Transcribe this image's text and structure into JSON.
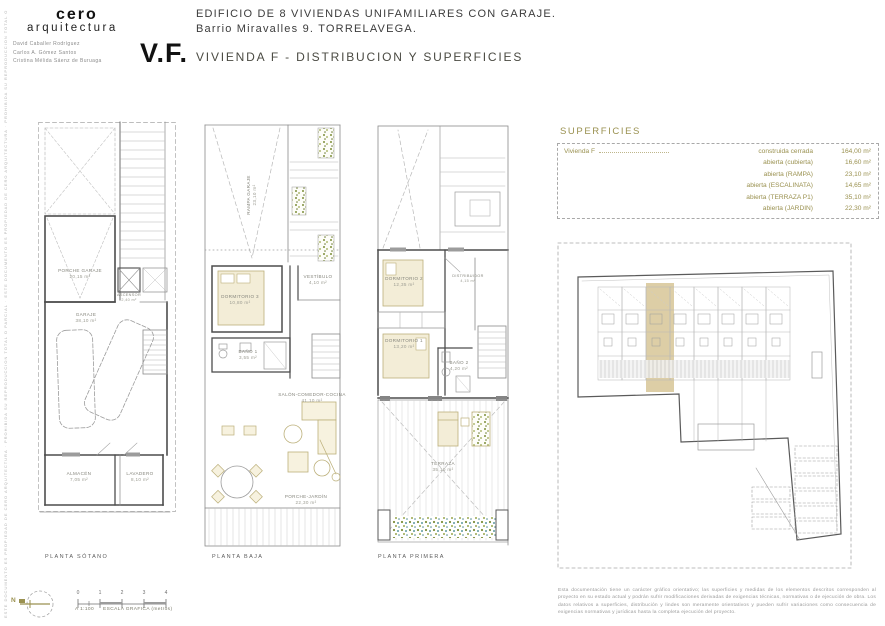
{
  "header": {
    "logo_line1": "cero",
    "logo_line2": "arquitectura",
    "architects": [
      "David Caballer Rodríguez",
      "Carlos A. Gómez Santos",
      "Cristina Mélida Sáenz de Buruaga"
    ],
    "project_line1": "EDIFICIO DE 8 VIVIENDAS UNIFAMILIARES CON GARAJE.",
    "project_line2": "Barrio Miravalles 9. TORRELAVEGA.",
    "sheet_code": "V.F.",
    "sheet_title": "VIVIENDA F -  DISTRIBUCION Y SUPERFICIES",
    "side_note": "ESTE DOCUMENTO ES PROPIEDAD DE CERO ARQUITECTURA · PROHIBIDA SU REPRODUCCION TOTAL O PARCIAL · ESTE DOCUMENTO ES PROPIEDAD DE CERO ARQUITECTURA · PROHIBIDA SU REPRODUCCION TOTAL O PARCIAL"
  },
  "plans": [
    {
      "label": "PLANTA SÓTANO",
      "rooms": [
        {
          "label": "PORCHE GARAJE",
          "area": "20,15 m²"
        },
        {
          "label": "GARAJE",
          "area": "38,10 m²"
        },
        {
          "label": "ALMACÉN",
          "area": "7,05 m²"
        },
        {
          "label": "LAVADERO",
          "area": "8,10 m²"
        },
        {
          "label": "ASCENSOR",
          "area": "2,40 m²"
        }
      ]
    },
    {
      "label": "PLANTA BAJA",
      "rooms": [
        {
          "label": "RAMPA GARAJE",
          "area": "23,10 m²"
        },
        {
          "label": "DORMITORIO 3",
          "area": "10,80 m²"
        },
        {
          "label": "BAÑO 1",
          "area": "3,55 m²"
        },
        {
          "label": "VESTÍBULO",
          "area": "4,10 m²"
        },
        {
          "label": "SALÓN-COMEDOR-COCINA",
          "area": "41,10 m²"
        },
        {
          "label": "PORCHE-JARDÍN",
          "area": "22,30 m²"
        }
      ]
    },
    {
      "label": "PLANTA PRIMERA",
      "rooms": [
        {
          "label": "DORMITORIO 2",
          "area": "12,35 m²"
        },
        {
          "label": "DORMITORIO 1",
          "area": "13,20 m²"
        },
        {
          "label": "BAÑO 2",
          "area": "4,20 m²"
        },
        {
          "label": "TERRAZA",
          "area": "35,10 m²"
        },
        {
          "label": "DISTRIBUIDOR",
          "area": "4,15 m²"
        }
      ]
    }
  ],
  "superficies": {
    "title": "SUPERFICIES",
    "unit": "Vivienda F",
    "rows": [
      {
        "label": "construida cerrada",
        "value": "164,00 m²"
      },
      {
        "label": "abierta (cubierta)",
        "value": "16,60 m²"
      },
      {
        "label": "abierta (RAMPA)",
        "value": "23,10 m²"
      },
      {
        "label": "abierta (ESCALINATA)",
        "value": "14,65 m²"
      },
      {
        "label": "abierta (TERRAZA P1)",
        "value": "35,10 m²"
      },
      {
        "label": "abierta (JARDIN)",
        "value": "22,30 m²"
      }
    ]
  },
  "footer": {
    "north_label": "N",
    "scale_ticks": [
      "0",
      "1",
      "2",
      "3",
      "4"
    ],
    "scale_prefix": "A 1:100",
    "scale_caption": "ESCALA GRAFICA (metros)",
    "disclaimer": "Esta documentación tiene un carácter gráfico orientativo; las superficies y medidas de los elementos descritos corresponden al proyecto en su estado actual y podrán sufrir modificaciones derivadas de exigencias técnicas, normativas o de ejecución de obra. Los datos relativos a superficies, distribución y lindes son meramente orientativos y pueden sufrir variaciones como consecuencia de exigencias normativas y jurídicas hasta la completa ejecución del proyecto."
  },
  "colors": {
    "accent_olive": "#9a9150",
    "unit_highlight": "#d9c99c",
    "planting_green": "#7f8f3b",
    "planting_teal": "#5f9aa0",
    "wall_line": "#4d4d4d"
  }
}
